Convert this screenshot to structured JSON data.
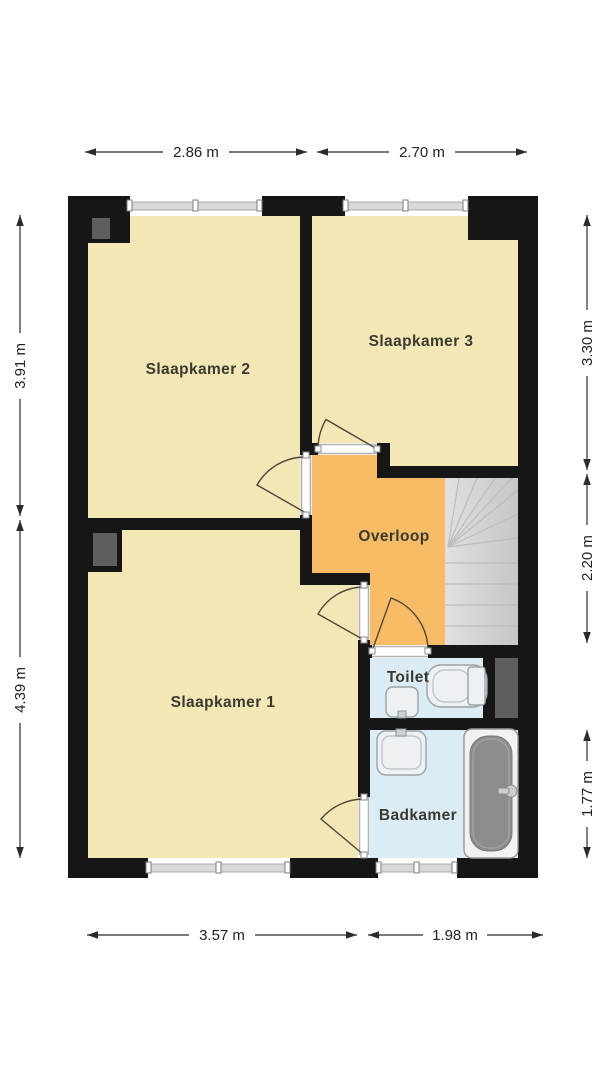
{
  "plan": {
    "rooms": [
      {
        "id": "slaapkamer2",
        "label": "Slaapkamer 2"
      },
      {
        "id": "slaapkamer3",
        "label": "Slaapkamer 3"
      },
      {
        "id": "slaapkamer1",
        "label": "Slaapkamer 1"
      },
      {
        "id": "overloop",
        "label": "Overloop"
      },
      {
        "id": "toilet",
        "label": "Toilet"
      },
      {
        "id": "badkamer",
        "label": "Badkamer"
      }
    ],
    "dimensions": {
      "top": [
        {
          "label": "2.86 m"
        },
        {
          "label": "2.70 m"
        }
      ],
      "bottom": [
        {
          "label": "3.57 m"
        },
        {
          "label": "1.98 m"
        }
      ],
      "left": [
        {
          "label": "3.91 m"
        },
        {
          "label": "4.39 m"
        }
      ],
      "right": [
        {
          "label": "3.30 m"
        },
        {
          "label": "2.20 m"
        },
        {
          "label": "1.77 m"
        }
      ]
    },
    "colors": {
      "background": "#ffffff",
      "wall": "#161616",
      "bedroom": "#f3e8b5",
      "hall": "#f8bc66",
      "wetroom": "#dbecf5",
      "stairs": "#d6d6d6",
      "duct": "#5e5e5e",
      "tub": "#8c8c8c"
    }
  }
}
